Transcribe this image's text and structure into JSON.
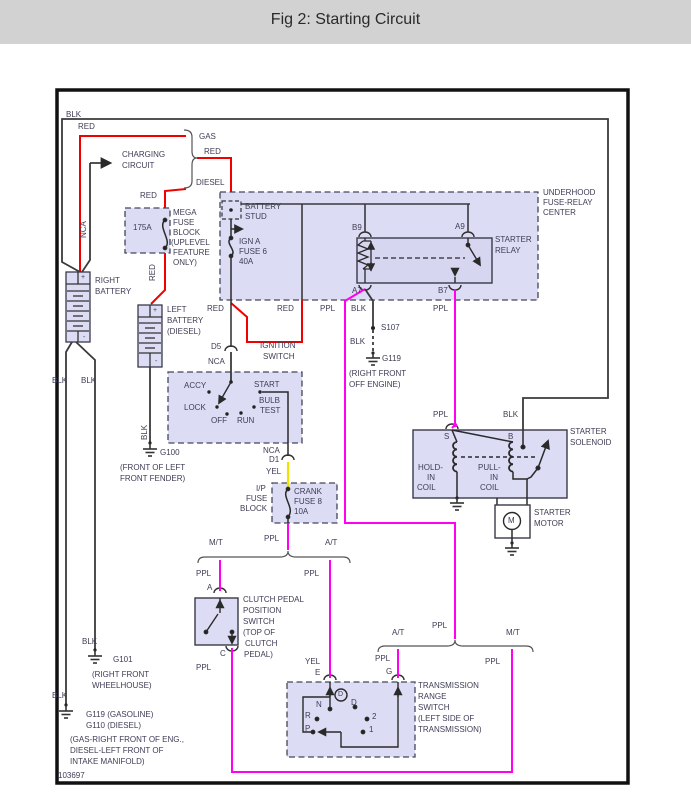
{
  "header": {
    "title": "Fig 2: Starting Circuit"
  },
  "footer": {
    "diagram_number": "103697"
  },
  "colors": {
    "red_wire": "#f10000",
    "purple_wire": "#ff00f0",
    "yellow_wire": "#efe400",
    "black_wire": "#3a3a3a",
    "component_fill": "#dcdcf4",
    "page_header_bg": "#d2d2d2",
    "label_color": "#3d3d55"
  },
  "wire_labels": {
    "blk": "BLK",
    "red": "RED",
    "ppl": "PPL",
    "yel": "YEL",
    "nca": "NCA"
  },
  "fuel_types": {
    "gas": "GAS",
    "diesel": "DIESEL"
  },
  "trans_types": {
    "mt": "M/T",
    "at": "A/T"
  },
  "charging_circuit": {
    "line1": "CHARGING",
    "line2": "CIRCUIT"
  },
  "right_battery": {
    "line1": "RIGHT",
    "line2": "BATTERY",
    "plus": "+",
    "minus": "-"
  },
  "left_battery": {
    "line1": "LEFT",
    "line2": "BATTERY",
    "line3": "(DIESEL)",
    "plus": "+",
    "minus": "-"
  },
  "mega_fuse_block": {
    "amp": "175A",
    "l1": "MEGA",
    "l2": "FUSE",
    "l3": "BLOCK",
    "l4": "(UPLEVEL",
    "l5": "FEATURE",
    "l6": "ONLY)"
  },
  "underhood_center": {
    "l1": "UNDERHOOD",
    "l2": "FUSE-RELAY",
    "l3": "CENTER",
    "stud1": "BATTERY",
    "stud2": "STUD",
    "fuse1": "IGN A",
    "fuse2": "FUSE 6",
    "fuse3": "40A"
  },
  "starter_relay": {
    "l1": "STARTER",
    "l2": "RELAY",
    "b9": "B9",
    "a9": "A9",
    "a7": "A7",
    "b7": "B7"
  },
  "ignition_switch": {
    "l1": "IGNITION",
    "l2": "SWITCH",
    "accy": "ACCY",
    "lock": "LOCK",
    "off": "OFF",
    "run": "RUN",
    "start": "START",
    "bulb": "BULB",
    "test": "TEST",
    "d5": "D5",
    "d1": "D1"
  },
  "ip_fuse_block": {
    "l1": "I/P",
    "l2": "FUSE",
    "l3": "BLOCK",
    "f1": "CRANK",
    "f2": "FUSE 8",
    "f3": "10A"
  },
  "starter_solenoid": {
    "l1": "STARTER",
    "l2": "SOLENOID",
    "s": "S",
    "b": "B",
    "h1": "HOLD-",
    "h2": "IN",
    "h3": "COIL",
    "p1": "PULL-",
    "p2": "IN",
    "p3": "COIL"
  },
  "starter_motor": {
    "l1": "STARTER",
    "l2": "MOTOR",
    "m": "M"
  },
  "clutch_switch": {
    "a": "A",
    "c": "C",
    "l1": "CLUTCH PEDAL",
    "l2": "POSITION",
    "l3": "SWITCH",
    "l4": "(TOP OF",
    "l5": "CLUTCH",
    "l6": "PEDAL)"
  },
  "trans_switch": {
    "e": "E",
    "g": "G",
    "l1": "TRANSMISSION",
    "l2": "RANGE",
    "l3": "SWITCH",
    "l4": "(LEFT SIDE OF",
    "l5": "TRANSMISSION)",
    "p": "P",
    "r": "R",
    "n": "N",
    "d_circled": "D",
    "d": "D",
    "two": "2",
    "one": "1"
  },
  "grounds": {
    "g100": {
      "name": "G100",
      "l1": "(FRONT OF LEFT",
      "l2": "FRONT FENDER)"
    },
    "g101": {
      "name": "G101",
      "l1": "(RIGHT FRONT",
      "l2": "WHEELHOUSE)"
    },
    "g119_engine": {
      "name": "G119",
      "l1": "(RIGHT FRONT",
      "l2": "OFF ENGINE)"
    },
    "g119_g110": {
      "l1": "G119 (GASOLINE)",
      "l2": "G110 (DIESEL)",
      "n1": "(GAS-RIGHT FRONT OF ENG.,",
      "n2": "DIESEL-LEFT FRONT OF",
      "n3": "INTAKE MANIFOLD)"
    },
    "s107": {
      "name": "S107"
    }
  }
}
